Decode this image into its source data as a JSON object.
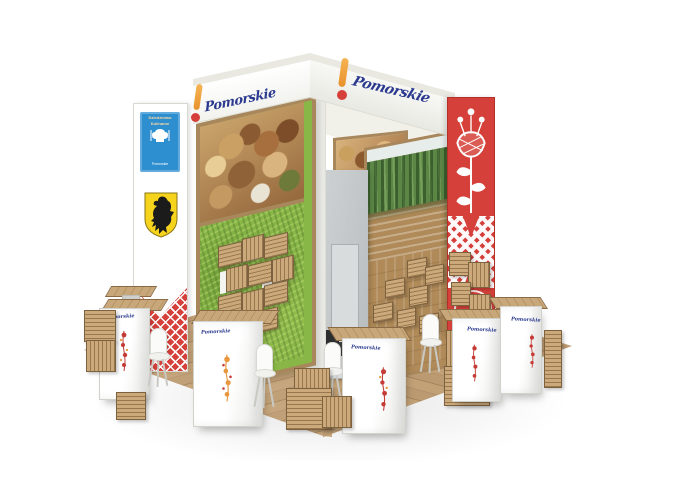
{
  "scene": {
    "subject": "3D visualization of the Pomorskie regional trade-fair exhibition stand",
    "background_color": "#ffffff"
  },
  "brand": {
    "name": "Pomorskie",
    "script_color": "#2b3a8f",
    "exclamation_bar_color": "#f2a33c",
    "exclamation_dot_color": "#d6403a"
  },
  "fascia": {
    "left_logo": "Pomorskie",
    "right_logo": "Pomorskie"
  },
  "left_totem": {
    "culinary_sign": {
      "bg_color": "#2e8fd0",
      "line1": "Dziedzictwo",
      "line2": "Kulinarne",
      "caption": "Pomorskie"
    },
    "coat_of_arms": {
      "name": "black-griffin-on-gold-shield",
      "shield_color": "#f6d31c",
      "griffin_color": "#1b1b1b"
    },
    "pattern": {
      "style": "red-diamond-lattice-with-white-chevron",
      "color": "#d6403a"
    }
  },
  "right_totem": {
    "bg_color": "#d6403a",
    "motif": "kashubian-folk-tulip",
    "motif_color": "#ffffff",
    "pattern": "white-diamond-lattice-band",
    "shelving": "wooden-crates-with-white-folk-flowers"
  },
  "walls": {
    "left": {
      "upper_graphic": "forest-mushrooms-basket-photo",
      "lower_finish": "green-moss-grass-wall",
      "shelving": "wooden-crate-shelves"
    },
    "right": {
      "upper_graphic": "forest-lake-photo",
      "lower_finish": "oak-slat-panel",
      "shelving": "wooden-crate-shelves"
    },
    "inner_graphic": "rustic-bread-food-photo"
  },
  "storage_room": {
    "wall_color": "#c6cbcd",
    "door_color": "#d8dcdd"
  },
  "counters": [
    {
      "logo": "Pomorskie",
      "motif": "red-folk-flower"
    },
    {
      "logo": "Pomorskie",
      "motif": "orange-folk-flower"
    },
    {
      "logo": "Pomorskie",
      "motif": "red-folk-flower"
    },
    {
      "logo": "Pomorskie",
      "motif": "red-folk-flower"
    },
    {
      "logo": "Pomorskie",
      "motif": "red-folk-flower"
    }
  ],
  "furniture": {
    "chair": "white-shell-chair",
    "crate": "wooden-crate-stool"
  },
  "floor": {
    "finish": "oak-plank-platform",
    "base_color": "#bf9e74"
  }
}
